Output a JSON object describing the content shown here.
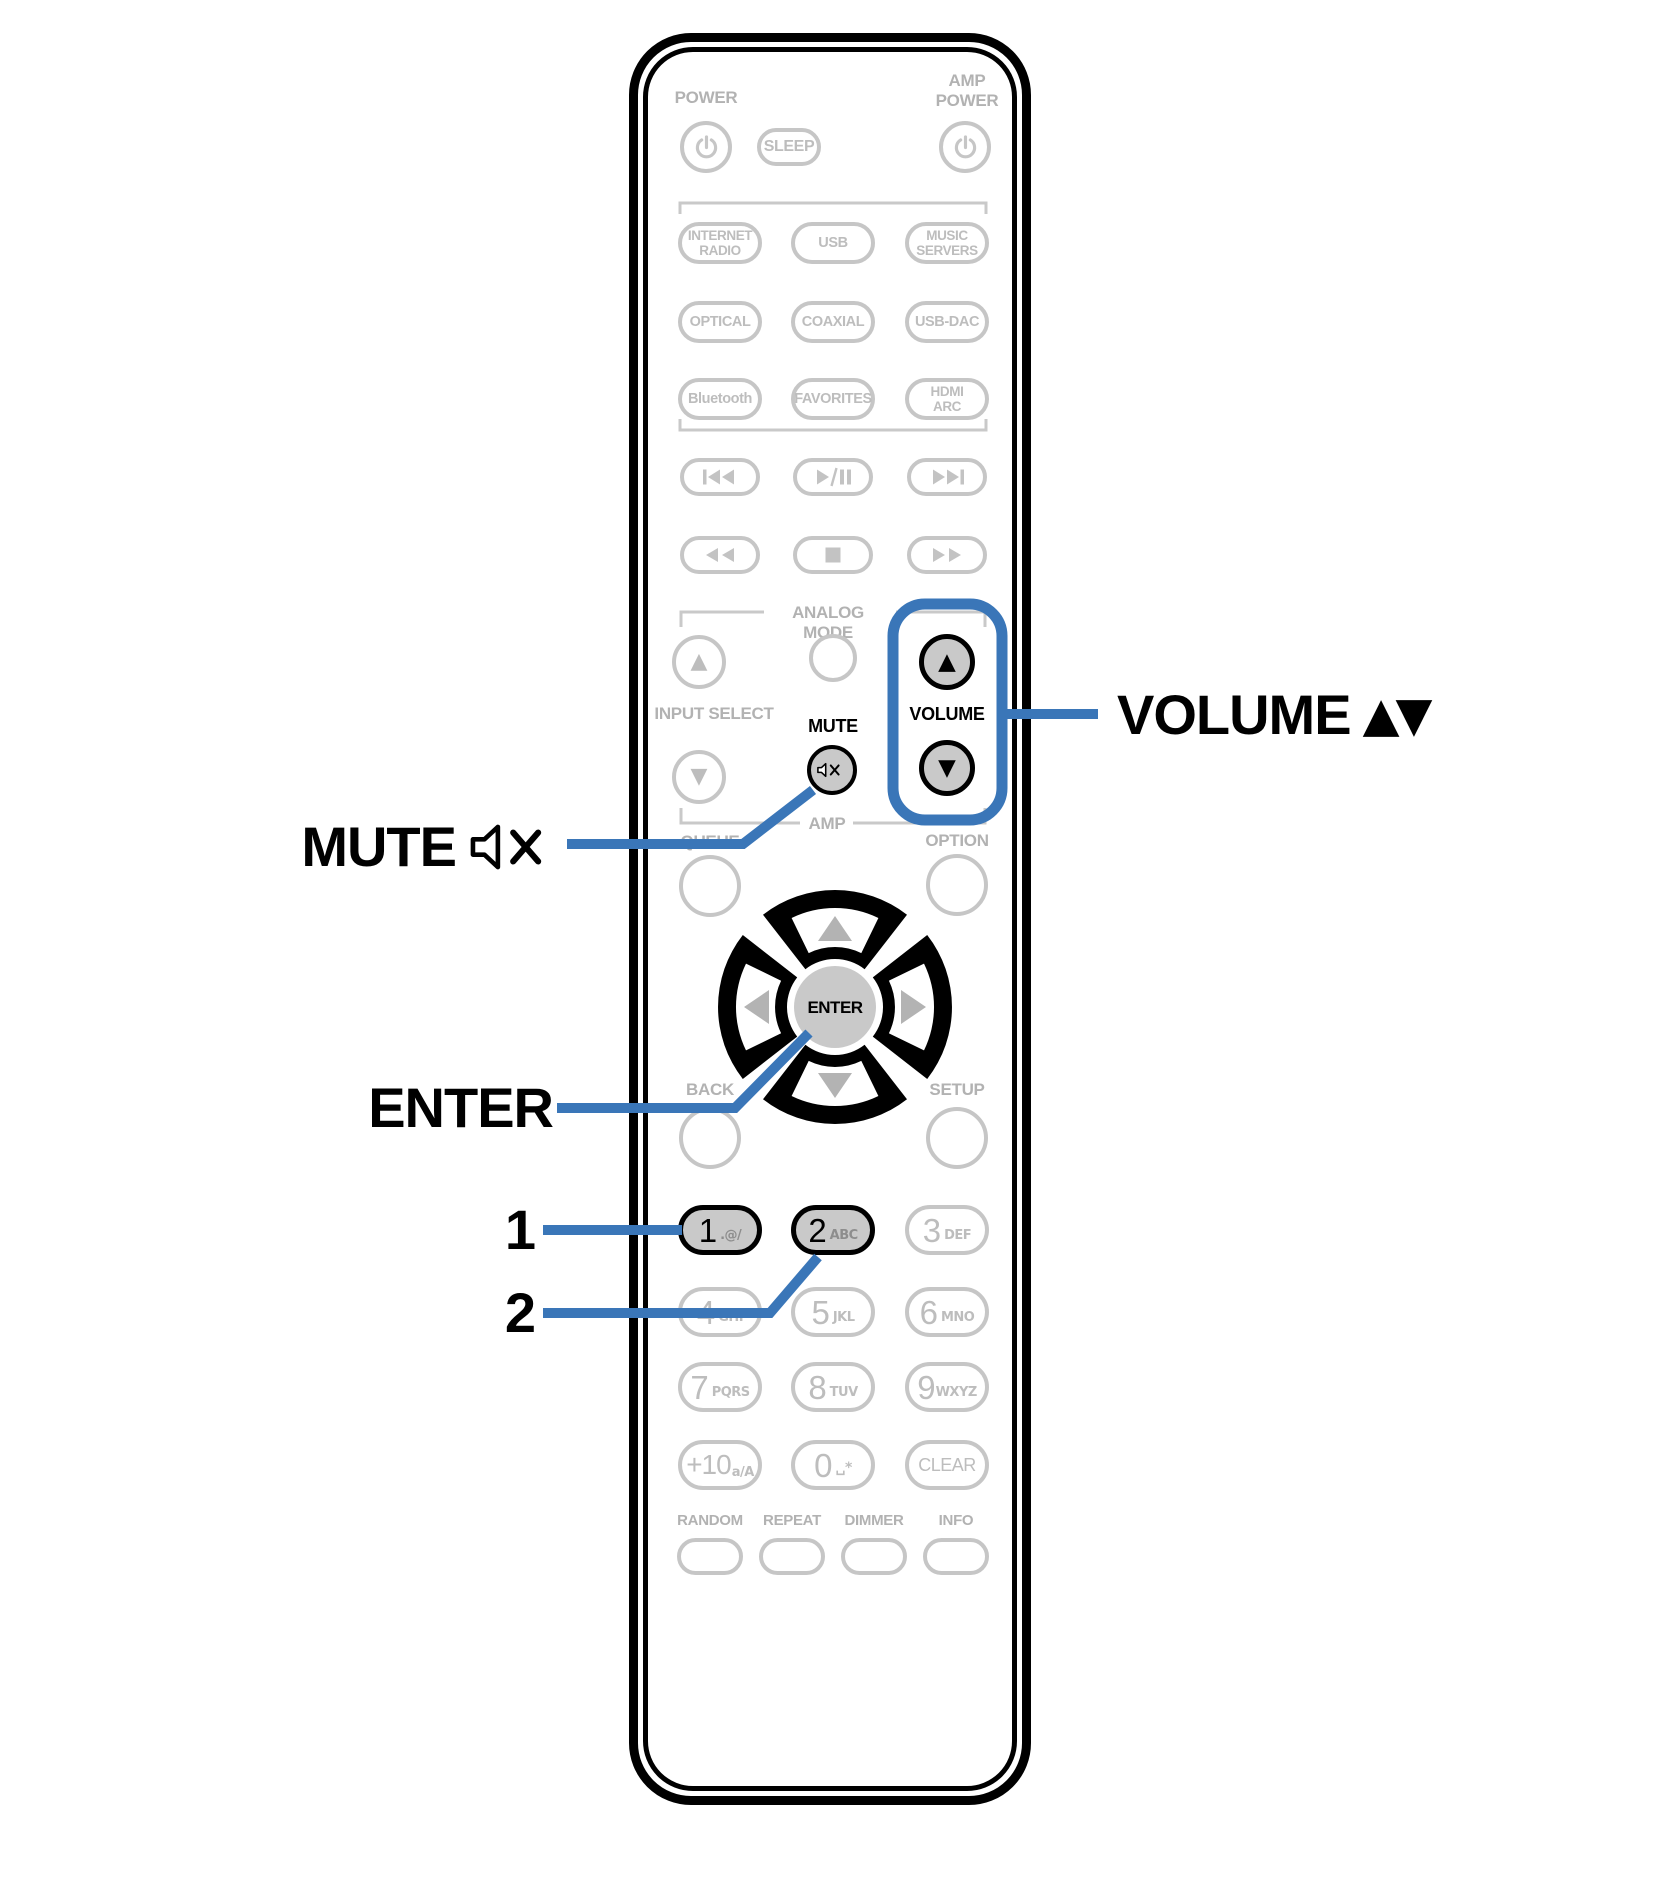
{
  "colors": {
    "accent_blue": "#3a76b8",
    "button_gray": "#c6c6c6",
    "label_gray": "#b2b2b2",
    "highlight_fill": "#c9c9c9",
    "outline_black": "#000000"
  },
  "callouts": {
    "volume": {
      "text": "VOLUME",
      "arrows": "▲▼"
    },
    "mute": {
      "text": "MUTE"
    },
    "enter": {
      "text": "ENTER"
    },
    "num1": {
      "text": "1"
    },
    "num2": {
      "text": "2"
    }
  },
  "remote": {
    "top": {
      "power_label": "POWER",
      "amp_power_line1": "AMP",
      "amp_power_line2": "POWER",
      "sleep_label": "SLEEP"
    },
    "sources": [
      "INTERNET\nRADIO",
      "USB",
      "MUSIC\nSERVERS",
      "OPTICAL",
      "COAXIAL",
      "USB-DAC",
      "Bluetooth",
      "FAVORITES",
      "HDMI\nARC"
    ],
    "labels": {
      "analog_mode": "ANALOG MODE",
      "input_select": "INPUT SELECT",
      "mute": "MUTE",
      "volume": "VOLUME",
      "amp": "AMP",
      "queue": "QUEUE",
      "option": "OPTION",
      "back": "BACK",
      "setup": "SETUP",
      "enter": "ENTER"
    },
    "numpad": [
      {
        "digit": "1",
        "sub": ".@/"
      },
      {
        "digit": "2",
        "sub": "ABC"
      },
      {
        "digit": "3",
        "sub": "DEF"
      },
      {
        "digit": "4",
        "sub": "GHI"
      },
      {
        "digit": "5",
        "sub": "JKL"
      },
      {
        "digit": "6",
        "sub": "MNO"
      },
      {
        "digit": "7",
        "sub": "PQRS"
      },
      {
        "digit": "8",
        "sub": "TUV"
      },
      {
        "digit": "9",
        "sub": "WXYZ"
      },
      {
        "digit": "+10",
        "sub": "a/A"
      },
      {
        "digit": "0",
        "sub": "␣*"
      },
      {
        "digit": "CLEAR",
        "sub": ""
      }
    ],
    "bottom_labels": [
      "RANDOM",
      "REPEAT",
      "DIMMER",
      "INFO"
    ]
  },
  "icons": {
    "power": "⏻",
    "sleep": "SLEEP",
    "skip_back": "⏮",
    "play_pause": "⏯",
    "skip_forward": "⏭",
    "rewind": "⏪",
    "stop": "⏹",
    "fast_forward": "⏩",
    "mute": "speaker-muted",
    "up_triangle": "▲",
    "down_triangle": "▼"
  }
}
